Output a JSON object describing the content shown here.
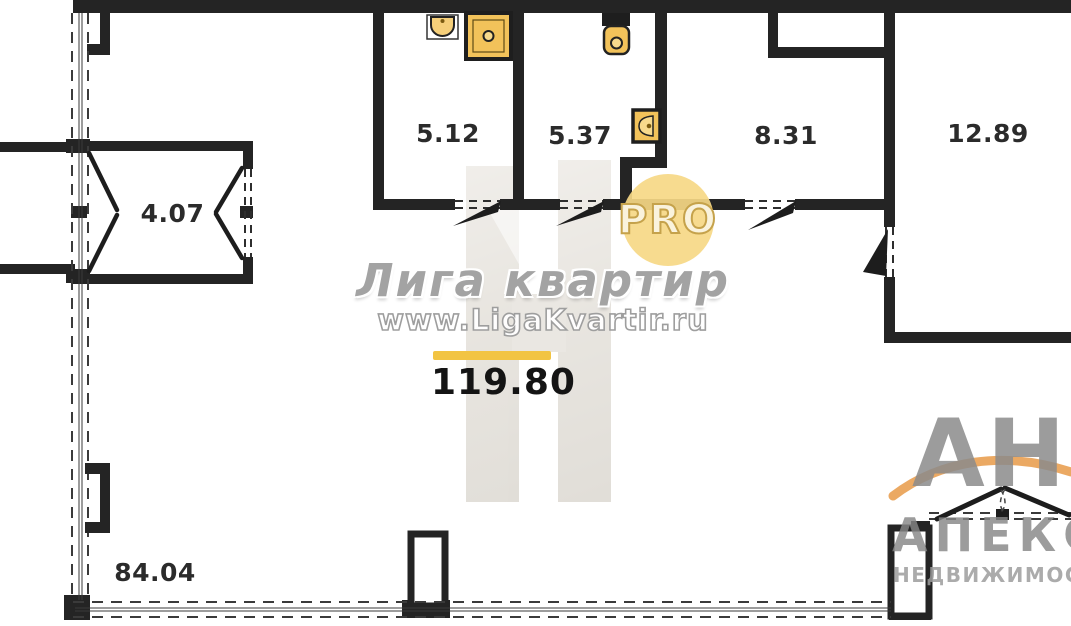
{
  "watermark": {
    "brand": "Лига квартир",
    "site": "www.LigaKvartir.ru",
    "badge": "PRO"
  },
  "agency": {
    "initials": "АН",
    "name": "АПЕКС",
    "subtitle": "НЕДВИЖИМОСТЬ"
  },
  "total": {
    "value": "119.80"
  },
  "rooms": {
    "vestibule": "4.07",
    "bathroom": "5.12",
    "toilet_room": "5.37",
    "hallway": "8.31",
    "room": "12.89",
    "great_room": "84.04"
  },
  "colors": {
    "wall": "#242424",
    "fixture_yellow": "#f2c25a",
    "badge_yellow": "#f6d885",
    "accent_bar": "#f2c443",
    "watermark_gray": "#9e9e9e"
  }
}
